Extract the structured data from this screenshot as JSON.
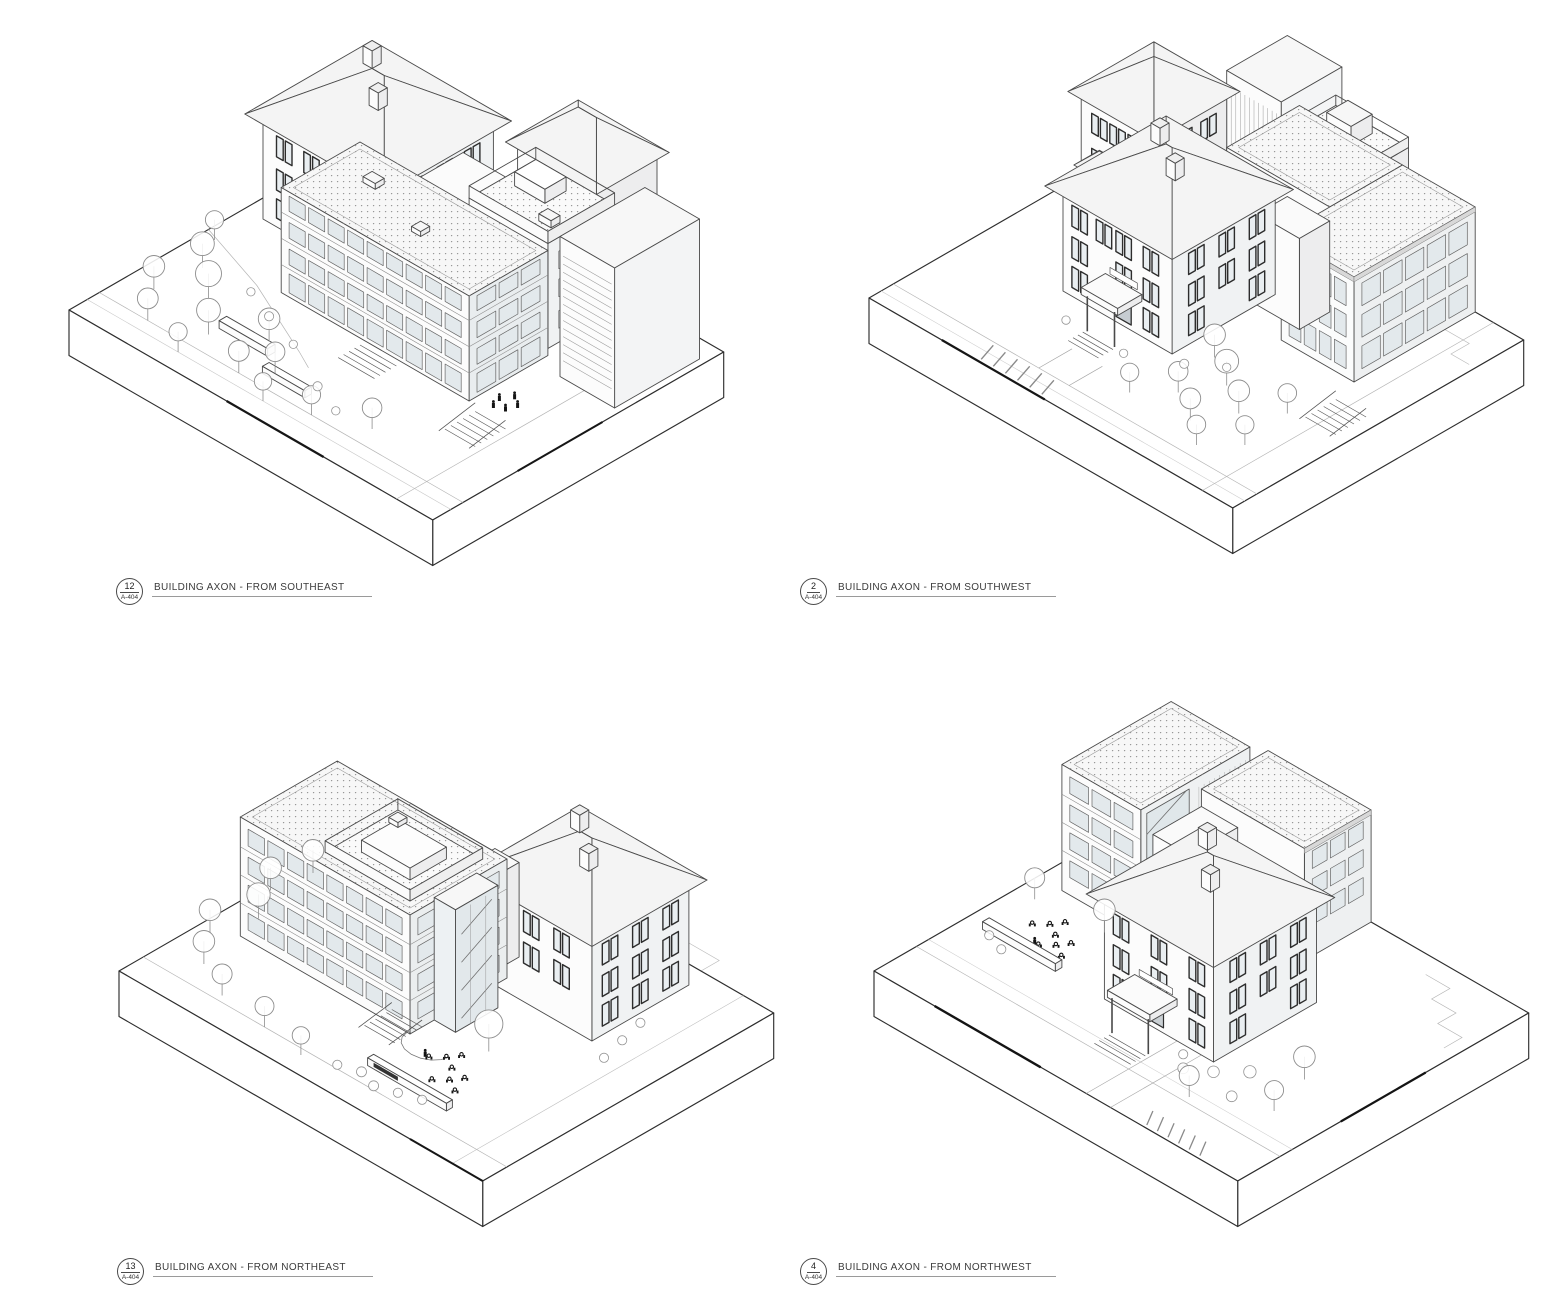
{
  "sheet": {
    "background_color": "#ffffff",
    "line_color": "#4a4a4a",
    "views": [
      {
        "key": "southeast",
        "detail_number": "12",
        "sheet_number": "A-404",
        "title": "BUILDING AXON - FROM SOUTHEAST"
      },
      {
        "key": "southwest",
        "detail_number": "2",
        "sheet_number": "A-404",
        "title": "BUILDING AXON - FROM SOUTHWEST"
      },
      {
        "key": "northeast",
        "detail_number": "13",
        "sheet_number": "A-404",
        "title": "BUILDING AXON - FROM NORTHEAST"
      },
      {
        "key": "northwest",
        "detail_number": "4",
        "sheet_number": "A-404",
        "title": "BUILDING AXON - FROM NORTHWEST"
      }
    ]
  }
}
